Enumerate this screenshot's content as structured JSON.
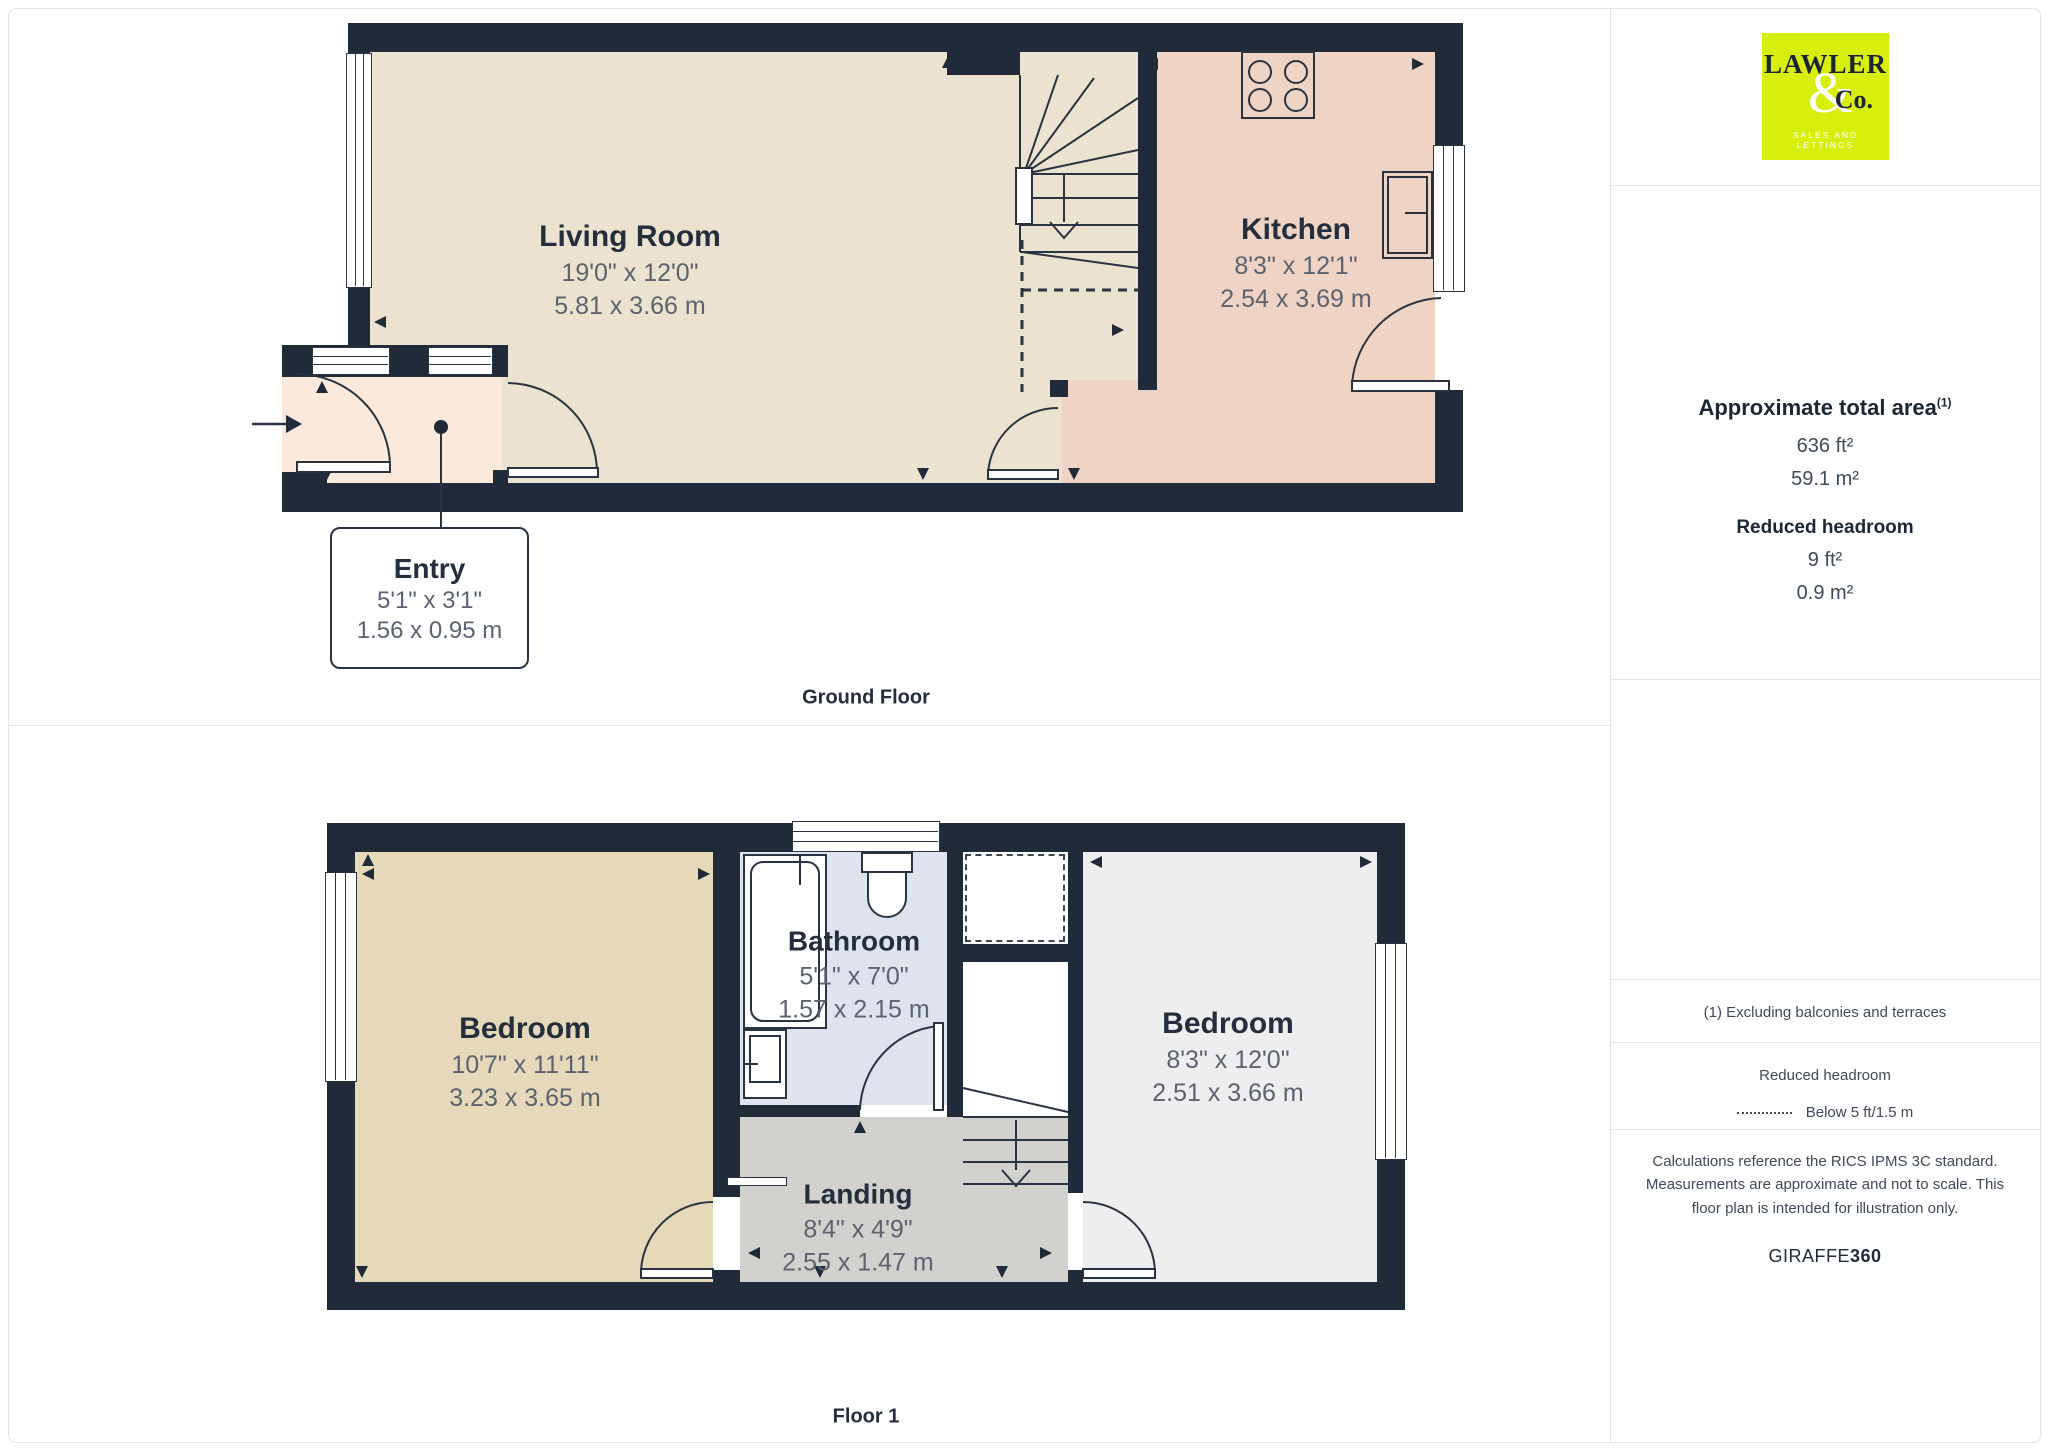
{
  "ground_floor": {
    "title": "Ground Floor",
    "rooms": {
      "living_room": {
        "name": "Living Room",
        "dims_imperial": "19'0\" x 12'0\"",
        "dims_metric": "5.81 x 3.66 m"
      },
      "kitchen": {
        "name": "Kitchen",
        "dims_imperial": "8'3\" x 12'1\"",
        "dims_metric": "2.54 x 3.69 m"
      },
      "entry": {
        "name": "Entry",
        "dims_imperial": "5'1\" x 3'1\"",
        "dims_metric": "1.56 x 0.95 m"
      }
    }
  },
  "floor_1": {
    "title": "Floor 1",
    "rooms": {
      "bedroom_left": {
        "name": "Bedroom",
        "dims_imperial": "10'7\" x 11'11\"",
        "dims_metric": "3.23 x 3.65 m"
      },
      "bathroom": {
        "name": "Bathroom",
        "dims_imperial": "5'1\" x 7'0\"",
        "dims_metric": "1.57 x 2.15 m"
      },
      "bedroom_right": {
        "name": "Bedroom",
        "dims_imperial": "8'3\" x 12'0\"",
        "dims_metric": "2.51 x 3.66 m"
      },
      "landing": {
        "name": "Landing",
        "dims_imperial": "8'4\" x 4'9\"",
        "dims_metric": "2.55 x 1.47 m"
      }
    }
  },
  "sidebar": {
    "logo": {
      "name": "LAWLER",
      "amp": "&",
      "co": "Co.",
      "tagline": "SALES AND LETTINGS",
      "bg_color": "#d8ef0e"
    },
    "area": {
      "heading": "Approximate total area",
      "superscript": "(1)",
      "value_ft": "636 ft²",
      "value_m": "59.1 m²"
    },
    "reduced_headroom": {
      "heading": "Reduced headroom",
      "value_ft": "9 ft²",
      "value_m": "0.9 m²"
    },
    "footnote": "(1) Excluding balconies and terraces",
    "legend": {
      "heading": "Reduced headroom",
      "label": "Below 5 ft/1.5 m"
    },
    "disclaimer": "Calculations reference the RICS IPMS 3C standard. Measurements are approximate and not to scale. This floor plan is intended for illustration only.",
    "brand": {
      "name": "GIRAFFE",
      "suffix": "360"
    }
  },
  "colors": {
    "wall": "#212a38",
    "living_room_fill": "#ebe3cf",
    "kitchen_fill": "#efd4c5",
    "entry_fill": "#fbe9dc",
    "bedroom_left_fill": "#e5d9ba",
    "bathroom_fill": "#dfe3ee",
    "bedroom_right_fill": "#eeeeef",
    "landing_fill": "#d3d1cd",
    "logo_bg": "#d8ef0e"
  }
}
